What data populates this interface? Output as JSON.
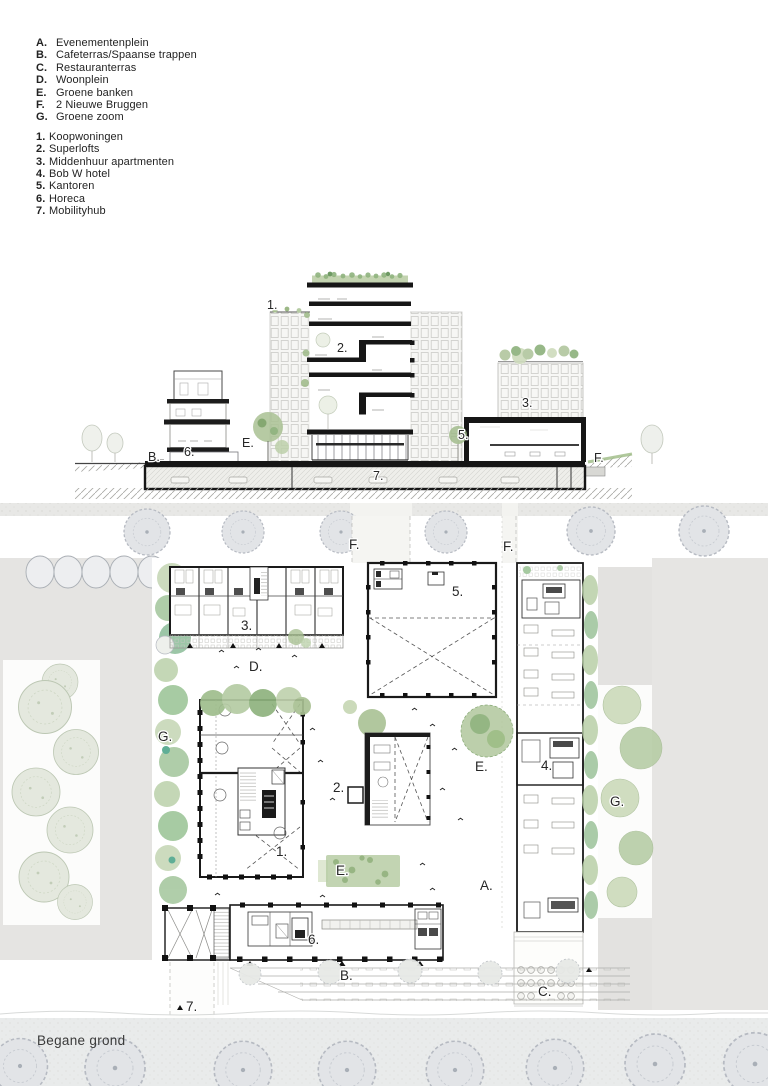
{
  "legend": {
    "areas": [
      {
        "key": "A.",
        "label": "Evenementenplein"
      },
      {
        "key": "B.",
        "label": "Cafeterras/Spaanse trappen"
      },
      {
        "key": "C.",
        "label": "Restauranterras"
      },
      {
        "key": "D.",
        "label": "Woonplein"
      },
      {
        "key": "E.",
        "label": "Groene banken"
      },
      {
        "key": "F.",
        "label": "2 Nieuwe Bruggen"
      },
      {
        "key": "G.",
        "label": "Groene zoom"
      }
    ],
    "buildings": [
      {
        "key": "1.",
        "label": "Koopwoningen"
      },
      {
        "key": "2.",
        "label": "Superlofts"
      },
      {
        "key": "3.",
        "label": "Middenhuur apartmenten"
      },
      {
        "key": "4.",
        "label": "Bob W hotel"
      },
      {
        "key": "5.",
        "label": "Kantoren"
      },
      {
        "key": "6.",
        "label": "Horeca"
      },
      {
        "key": "7.",
        "label": "Mobilityhub"
      }
    ]
  },
  "section": {
    "labels": {
      "n1": "1.",
      "n2": "2.",
      "n3": "3.",
      "n5": "5.",
      "n6": "6.",
      "n7": "7.",
      "b": "B.",
      "e": "E.",
      "f": "F."
    }
  },
  "plan": {
    "labels": {
      "n1": "1.",
      "n2": "2.",
      "n3": "3.",
      "n4": "4.",
      "n5": "5.",
      "n6": "6.",
      "n7": "7.",
      "a": "A.",
      "b": "B.",
      "c": "C.",
      "d": "D.",
      "e_bench": "E.",
      "e_tree": "E.",
      "f_left": "F.",
      "f_right": "F.",
      "g_left": "G.",
      "g_right": "G."
    },
    "caption": "Begane grond"
  },
  "colors": {
    "paper": "#ffffff",
    "ink": "#1c1c1c",
    "label_text": "#262626",
    "street_gray": "#e8e8e6",
    "block_gray": "#e5e4e2",
    "tree_gray_fill": "#e2e4e7",
    "tree_gray_stroke": "#b6bac2",
    "park_green_pale": "#e4e8de",
    "green_light": "#c6d7b6",
    "green_mid": "#a9c193",
    "green_dark": "#8fb37e",
    "teal_accent": "#5fae96"
  }
}
